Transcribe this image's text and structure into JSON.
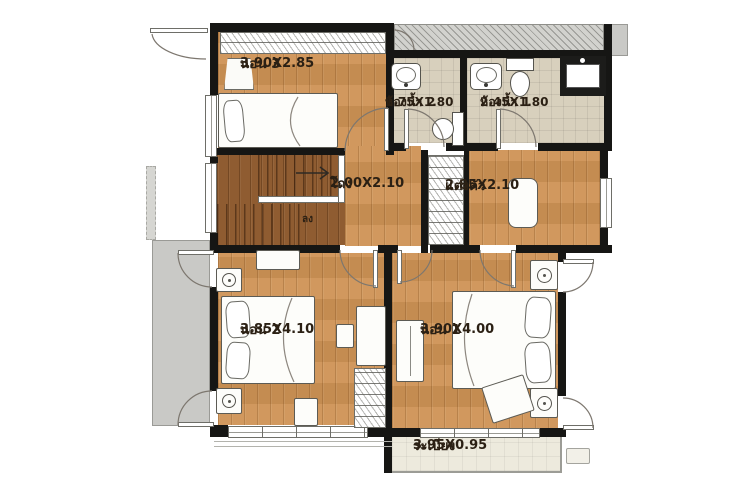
{
  "rooms": {
    "bedroom3": {
      "name": "นอน 3",
      "size": "3.90X2.85"
    },
    "bathroom2": {
      "name": "ห้องน้ำ 2",
      "size": "1.75X1.80"
    },
    "bathroom1": {
      "name": "ห้องน้ำ 1",
      "size": "2.45X1.80"
    },
    "hall": {
      "name": "โถง",
      "size": "2.00X2.10"
    },
    "dressing": {
      "name": "แต่งตัว",
      "size": "2.85X2.10"
    },
    "bedroom2": {
      "name": "นอน 2",
      "size": "3.85X4.10"
    },
    "bedroom1": {
      "name": "นอน 1",
      "size": "3.90X4.00"
    },
    "balcony": {
      "name": "ระเบียง",
      "size": "3.95X0.95"
    }
  },
  "stairs": {
    "down_label": "ลง"
  },
  "colors": {
    "wall": "#161614",
    "wood_floor": "#cf9355",
    "wood_dark": "#8f5c31",
    "bathroom_tile": "#d8d0bd",
    "balcony_floor": "#edeadd",
    "exterior_gray": "#c9c9c6",
    "label_text": "#2b2014"
  }
}
